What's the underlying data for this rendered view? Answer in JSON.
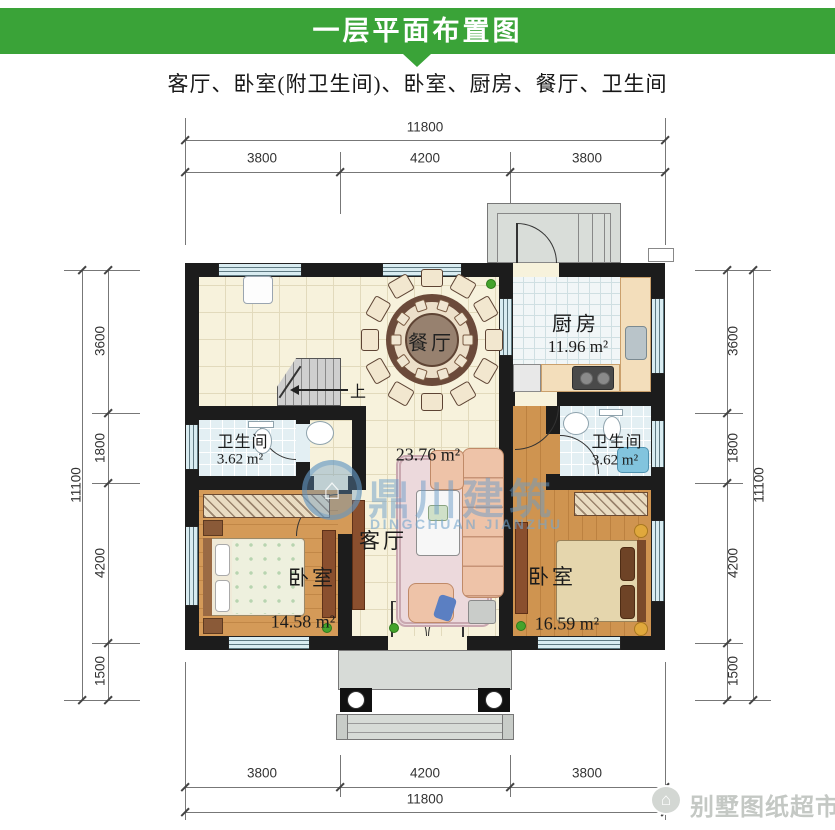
{
  "header": {
    "title": "一层平面布置图",
    "bg": "#3aa338"
  },
  "subtitle": "客厅、卧室(附卫生间)、卧室、厨房、餐厅、卫生间",
  "dims": {
    "top": {
      "total": "11800",
      "segs": [
        "3800",
        "4200",
        "3800"
      ]
    },
    "bottom": {
      "total": "11800",
      "segs": [
        "3800",
        "4200",
        "3800"
      ]
    },
    "left": {
      "total": "11100",
      "segs": [
        "3600",
        "1800",
        "4200",
        "1500"
      ]
    },
    "right": {
      "total": "11100",
      "segs": [
        "3600",
        "1800",
        "4200",
        "1500"
      ]
    }
  },
  "rooms": {
    "kitchen": {
      "name": "厨房",
      "area": "11.96 m²"
    },
    "dining": {
      "name": "餐厅"
    },
    "living": {
      "name": "客厅",
      "area": "23.76 m²"
    },
    "bath_left": {
      "name": "卫生间",
      "area": "3.62 m²"
    },
    "bath_right": {
      "name": "卫生间",
      "area": "3.62 m²"
    },
    "bedroom_left": {
      "name": "卧室",
      "area": "14.58 m²"
    },
    "bedroom_right": {
      "name": "卧室",
      "area": "16.59 m²"
    }
  },
  "stairs": {
    "up": "上"
  },
  "watermark": {
    "cn": "鼎川建筑",
    "en": "DINGCHUAN JIANZHU",
    "icon": "house-logo-icon"
  },
  "brand": {
    "text": "别墅图纸超市",
    "icon": "house-badge-icon"
  },
  "colors": {
    "header_green": "#3aa338",
    "watermark_blue": "#7fb2d6",
    "wall_black": "#1c1c1c"
  }
}
